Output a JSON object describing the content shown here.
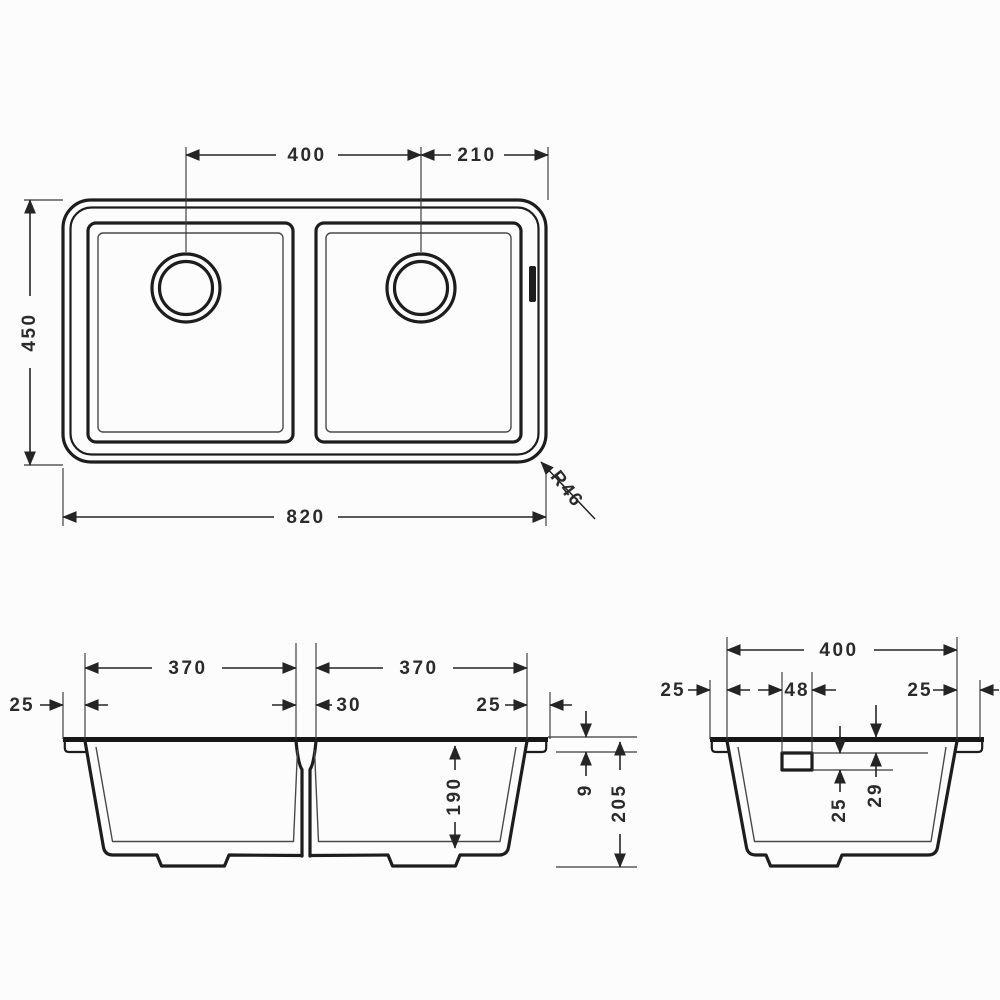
{
  "drawing": {
    "kind": "sink-dimension-drawing",
    "colors": {
      "line": "#1d1d1d",
      "dim_text": "#2b2b2b",
      "background": "#fcfcfc"
    },
    "views": {
      "top": {
        "dims": {
          "spacing": "400",
          "edge": "210",
          "depth": "450",
          "width": "820",
          "radius": "R46"
        }
      },
      "front": {
        "dims": {
          "bowl_left": "370",
          "bowl_right": "370",
          "flange_left": "25",
          "divider": "30",
          "flange_right": "25",
          "bowl_depth": "190",
          "rim": "9",
          "height": "205"
        }
      },
      "side": {
        "dims": {
          "width": "400",
          "flange_left": "25",
          "overflow_width": "48",
          "flange_right": "25",
          "overflow_height": "25",
          "overflow_offset": "29"
        }
      }
    }
  }
}
